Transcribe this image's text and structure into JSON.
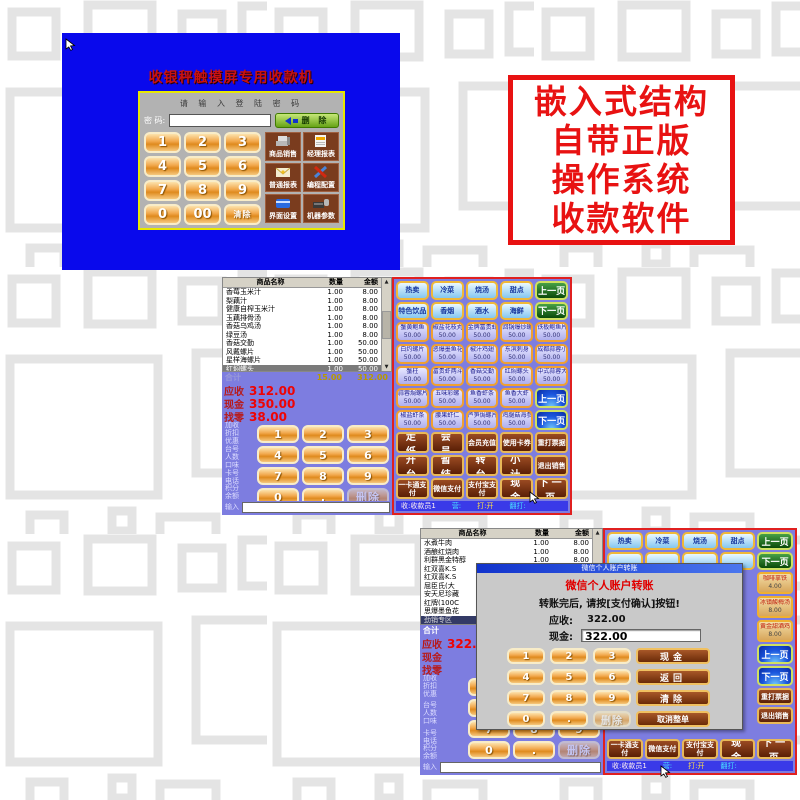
{
  "colors": {
    "callout_red": "#e81212",
    "screen_blue": "#0909ec",
    "pos_purple": "#7d7de0"
  },
  "callout": {
    "lines": [
      "嵌入式结构",
      "自带正版",
      "操作系统",
      "收款软件"
    ]
  },
  "login": {
    "title": "收银秤触摸屏专用收款机",
    "prompt": "请 输 入 登 陆 密 码",
    "password_label": "密 码:",
    "backspace_label": "删 除",
    "keys": [
      "1",
      "2",
      "3",
      "4",
      "5",
      "6",
      "7",
      "8",
      "9",
      "0",
      "00",
      "清除"
    ],
    "menu": [
      {
        "label": "商品销售"
      },
      {
        "label": "经理报表"
      },
      {
        "label": "普通报表"
      },
      {
        "label": "编程配置"
      },
      {
        "label": "界面设置"
      },
      {
        "label": "机器参数"
      }
    ]
  },
  "pos1": {
    "table_headers": [
      "商品名称",
      "数量",
      "金额"
    ],
    "rows": [
      {
        "name": "香莓玉米汁",
        "qty": "1.00",
        "amt": "8.00"
      },
      {
        "name": "梨藕汁",
        "qty": "1.00",
        "amt": "8.00"
      },
      {
        "name": "健康自榨玉米汁",
        "qty": "1.00",
        "amt": "8.00"
      },
      {
        "name": "玉藕排骨汤",
        "qty": "1.00",
        "amt": "8.00"
      },
      {
        "name": "香菇乌鸡汤",
        "qty": "1.00",
        "amt": "8.00"
      },
      {
        "name": "绿豆汤",
        "qty": "1.00",
        "amt": "8.00"
      },
      {
        "name": "香菇交勤",
        "qty": "1.00",
        "amt": "50.00"
      },
      {
        "name": "风戴螺片",
        "qty": "1.00",
        "amt": "50.00"
      },
      {
        "name": "星样海螺片",
        "qty": "1.00",
        "amt": "50.00"
      },
      {
        "name": "红焖螺头",
        "qty": "1.00",
        "amt": "50.00"
      }
    ],
    "total_label": "合计",
    "total_qty": "15.00",
    "total_amt": "312.00",
    "due_label": "应收",
    "due": "312.00",
    "cash_label": "现金",
    "cash": "350.00",
    "change_label": "找零",
    "change": "38.00",
    "side_labels": [
      "加收",
      "折扣",
      "优惠",
      "台号",
      "人数",
      "口味",
      "卡号",
      "电话",
      "积分",
      "余额"
    ],
    "input_label": "输入",
    "keys": [
      "1",
      "2",
      "3",
      "4",
      "5",
      "6",
      "7",
      "8",
      "9",
      "0",
      ".",
      "删除"
    ],
    "categories": [
      "热卖",
      "冷菜",
      "烧汤",
      "甜点",
      "特色饮品",
      "香烟",
      "酒水",
      "海鲜"
    ],
    "pager_green_prev": "上一页",
    "pager_green_next": "下一页",
    "pager_blue_prev": "上一页",
    "pager_blue_next": "下一页",
    "products": [
      {
        "name": "蟹黄鲍鱼",
        "price": "50.00"
      },
      {
        "name": "椒盐花枝丸",
        "price": "50.00"
      },
      {
        "name": "金牌富贵虾",
        "price": "50.00"
      },
      {
        "name": "回锅爆炒螺",
        "price": "50.00"
      },
      {
        "name": "铁板鲍鱼片",
        "price": "50.00"
      },
      {
        "name": "白灼螺片",
        "price": "50.00"
      },
      {
        "name": "恶爆墨鱼花",
        "price": "50.00"
      },
      {
        "name": "椒汁鸡翅",
        "price": "50.00"
      },
      {
        "name": "东滨刺身",
        "price": "50.00"
      },
      {
        "name": "成都蒜蓉小龙虾",
        "price": "50.00"
      },
      {
        "name": "蟹柱",
        "price": "50.00"
      },
      {
        "name": "富贵虾两斗",
        "price": "50.00"
      },
      {
        "name": "香菇交勤",
        "price": "50.00"
      },
      {
        "name": "红焖螺头",
        "price": "50.00"
      },
      {
        "name": "中式蒜蓉大虾",
        "price": "50.00"
      },
      {
        "name": "蒜蓉焗螺片",
        "price": "50.00"
      },
      {
        "name": "五味彩螺",
        "price": "50.00"
      },
      {
        "name": "鱼香虾条",
        "price": "50.00"
      },
      {
        "name": "鱼香大虾",
        "price": "50.00"
      },
      {
        "name": "椒盐虾条",
        "price": "50.00"
      },
      {
        "name": "腰果虾仁",
        "price": "50.00"
      },
      {
        "name": "芦笋焗螺片",
        "price": "50.00"
      },
      {
        "name": "鸡腿菇海参",
        "price": "50.00"
      }
    ],
    "actions": [
      "走 纸",
      "会 员",
      "会员充值",
      "使用卡券",
      "重打票据",
      "开 台",
      "暂 结",
      "转 台",
      "小 计",
      "退出销售",
      "一卡通支付",
      "微信支付",
      "支付宝支付",
      "现 金",
      "下一页"
    ],
    "status": {
      "cashier": "收:收款员1",
      "shift": "营:",
      "print": "打:开",
      "reprint": "翻打:"
    }
  },
  "pos2": {
    "table_headers": [
      "商品名称",
      "数量",
      "金额"
    ],
    "rows": [
      {
        "name": "水煮牛肉",
        "qty": "1.00",
        "amt": "8.00"
      },
      {
        "name": "酒酿红烧肉",
        "qty": "1.00",
        "amt": "8.00"
      },
      {
        "name": "利群黑金特醇",
        "qty": "1.00",
        "amt": "8.00"
      },
      {
        "name": "红双喜K.S"
      },
      {
        "name": "红双喜K.S"
      },
      {
        "name": "屈臣氏(大"
      },
      {
        "name": "安天尼珍藏"
      },
      {
        "name": "红牌(100C"
      },
      {
        "name": "思爆墨鱼花"
      }
    ],
    "selected_row": "劲销专区",
    "total_label": "合计",
    "due_label": "应收",
    "due": "322.00",
    "cash_label": "现金",
    "cash": "",
    "change_label": "找零",
    "change": "",
    "side_labels": [
      "加收",
      "折扣",
      "优惠",
      "台号",
      "人数",
      "口味",
      "卡号",
      "电话",
      "积分",
      "余额"
    ],
    "input_label": "输入",
    "keys": [
      "1",
      "2",
      "3",
      "4",
      "5",
      "6",
      "7",
      "8",
      "9",
      "0",
      ".",
      "删除"
    ],
    "categories": [
      "热卖",
      "冷菜",
      "烧汤",
      "甜点"
    ],
    "pager_green_prev": "上一页",
    "pager_green_next": "下一页",
    "right_products": [
      {
        "name": "咖啡拿铁",
        "price": "4.00"
      },
      {
        "name": "冰镇酸梅汤",
        "price": "8.00"
      },
      {
        "name": "黄金甜酒鸡",
        "price": "8.00"
      }
    ],
    "pager_blue_prev": "上一页",
    "pager_blue_next": "下一页",
    "reprint_label": "重打票据",
    "exit_label": "退出销售",
    "payments": [
      "一卡通支付",
      "微信支付",
      "支付宝支付",
      "现 金",
      "下一页"
    ],
    "status": {
      "cashier": "收:收款员1",
      "shift": "营:",
      "print": "打:开",
      "reprint": "翻打:"
    }
  },
  "dialog": {
    "titlebar": "微信个人账户转账",
    "heading": "微信个人账户转账",
    "instruction": "转账完后, 请按[支付确认]按钮!",
    "due_label": "应收:",
    "due": "322.00",
    "cash_label": "现金:",
    "cash": "322.00",
    "keys": [
      "1",
      "2",
      "3",
      "4",
      "5",
      "6",
      "7",
      "8",
      "9",
      "0",
      ".",
      "删除"
    ],
    "side_buttons": [
      "现金",
      "返回",
      "清除",
      "取消整单"
    ]
  }
}
